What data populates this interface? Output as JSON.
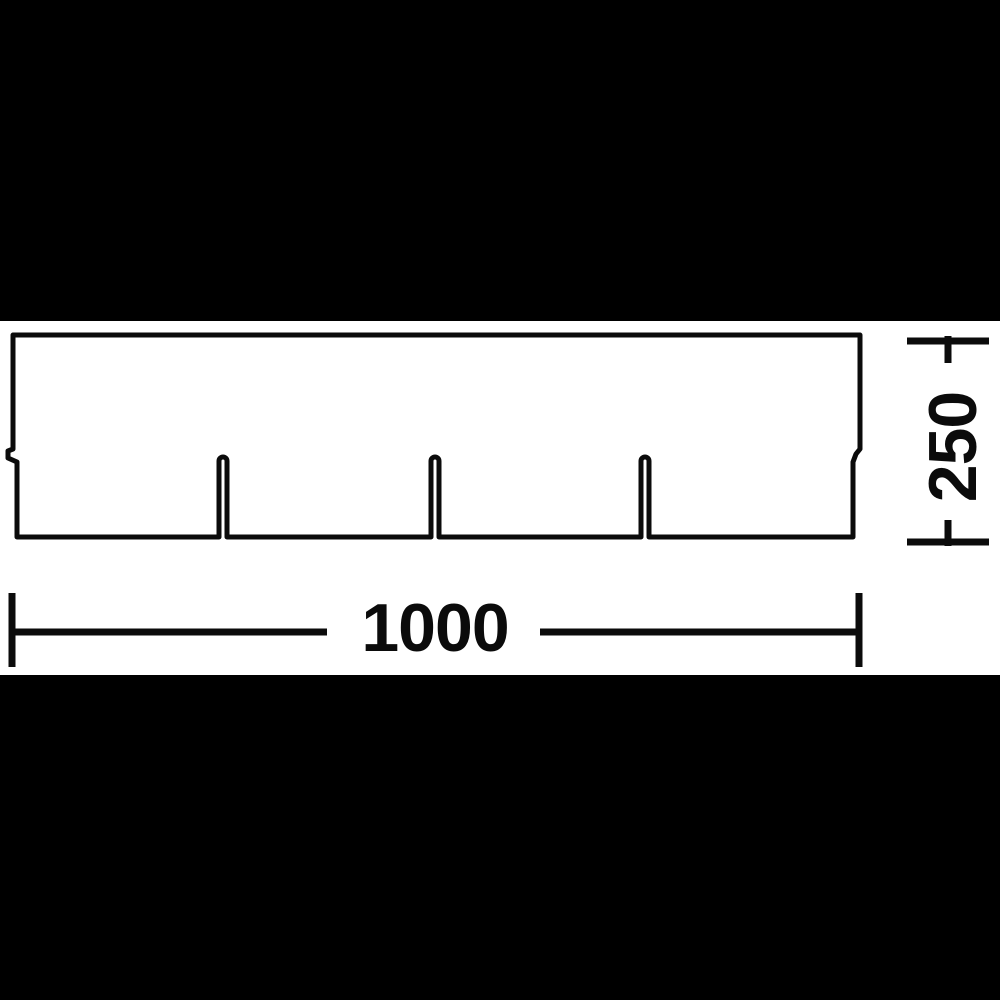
{
  "colors": {
    "background": "#000000",
    "canvas": "#ffffff",
    "ink": "#0b0b0b"
  },
  "dimensions": {
    "width": {
      "label": "1000"
    },
    "height": {
      "label": "250"
    }
  },
  "shingle": {
    "left": 13,
    "top": 335,
    "right": 860,
    "bottom": 537,
    "lower_left": 17,
    "lower_right": 853,
    "notch_top_y": 449,
    "notch_bottom_y": 462,
    "left_tooth_x": 8,
    "slot_centers": [
      223,
      435,
      645
    ],
    "slot_half_width": 4,
    "slot_chord_y": 461
  }
}
